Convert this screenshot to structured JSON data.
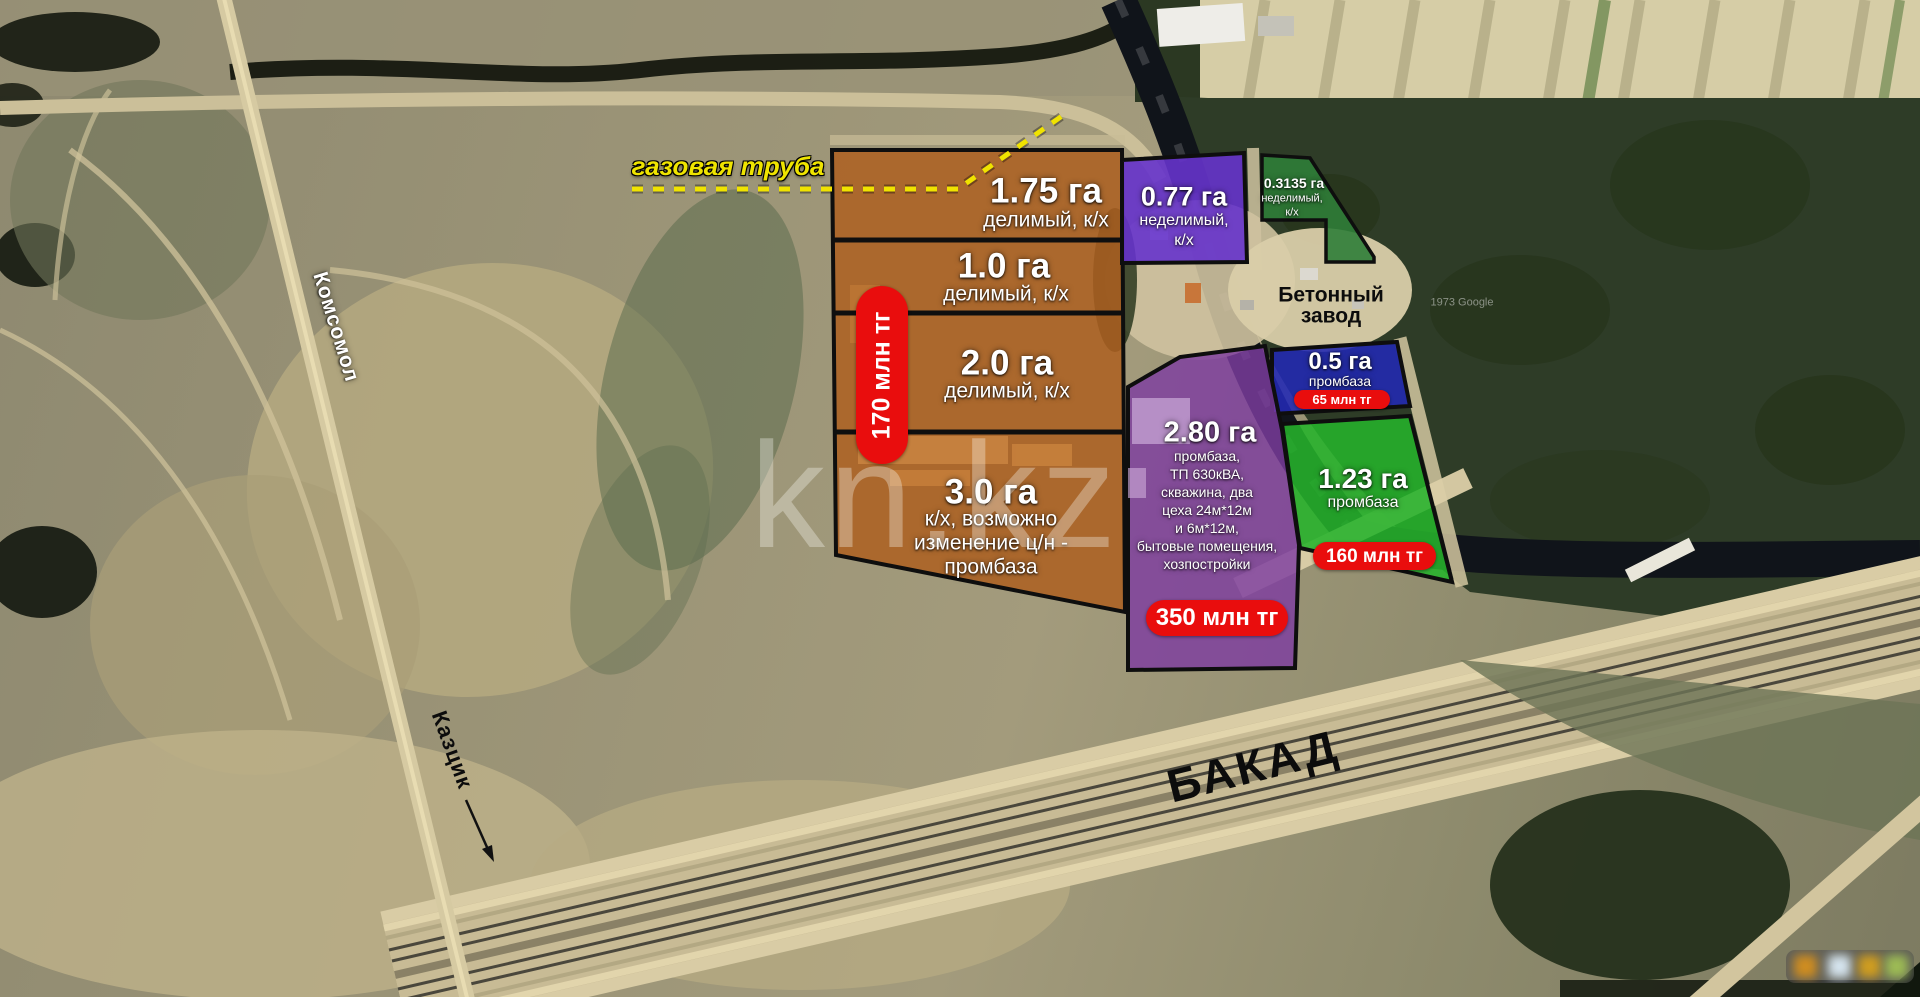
{
  "overlay": {
    "gas_pipe_label": "газовая труба",
    "watermark": "kn.kz",
    "attribution": "1973 Google",
    "road_komsomol": "Комсомол",
    "road_kazcik": "Казцик",
    "road_bakad": "БАКАД",
    "concrete_plant": {
      "line1": "Бетонный",
      "line2": "завод"
    }
  },
  "parcels": {
    "orange_group": {
      "price": "170 млн тг",
      "rows": [
        {
          "area": "1.75 га",
          "desc": "делимый, к/х"
        },
        {
          "area": "1.0 га",
          "desc": "делимый, к/х"
        },
        {
          "area": "2.0 га",
          "desc": "делимый, к/х"
        },
        {
          "area": "3.0 га",
          "desc_lines": [
            "к/х, возможно",
            "изменение ц/н -",
            "промбаза"
          ]
        }
      ]
    },
    "purple_small": {
      "area": "0.77 га",
      "desc_lines": [
        "неделимый,",
        "к/х"
      ]
    },
    "green_small": {
      "area": "0.3135 га",
      "desc_lines": [
        "неделимый,",
        "к/х"
      ]
    },
    "blue": {
      "area": "0.5 га",
      "desc": "промбаза",
      "price": "65 млн тг"
    },
    "purple_large": {
      "area": "2.80 га",
      "desc_lines": [
        "промбаза,",
        "ТП 630кВА,",
        "скважина, два",
        "цеха 24м*12м",
        "и 6м*12м,",
        "бытовые помещения,",
        "хозпостройки"
      ],
      "price": "350 млн тг"
    },
    "green_large": {
      "area": "1.23 га",
      "desc": "промбаза",
      "price": "160 млн тг"
    }
  },
  "colors": {
    "orange": "#ad5f20",
    "purple_small": "#6633cc",
    "green_small": "#2f7d38",
    "blue": "#2229b4",
    "purple_large": "#7e3da0",
    "green_large": "#25b32b",
    "price_red": "#e90d0d",
    "pipe_yellow": "#f0e300"
  }
}
